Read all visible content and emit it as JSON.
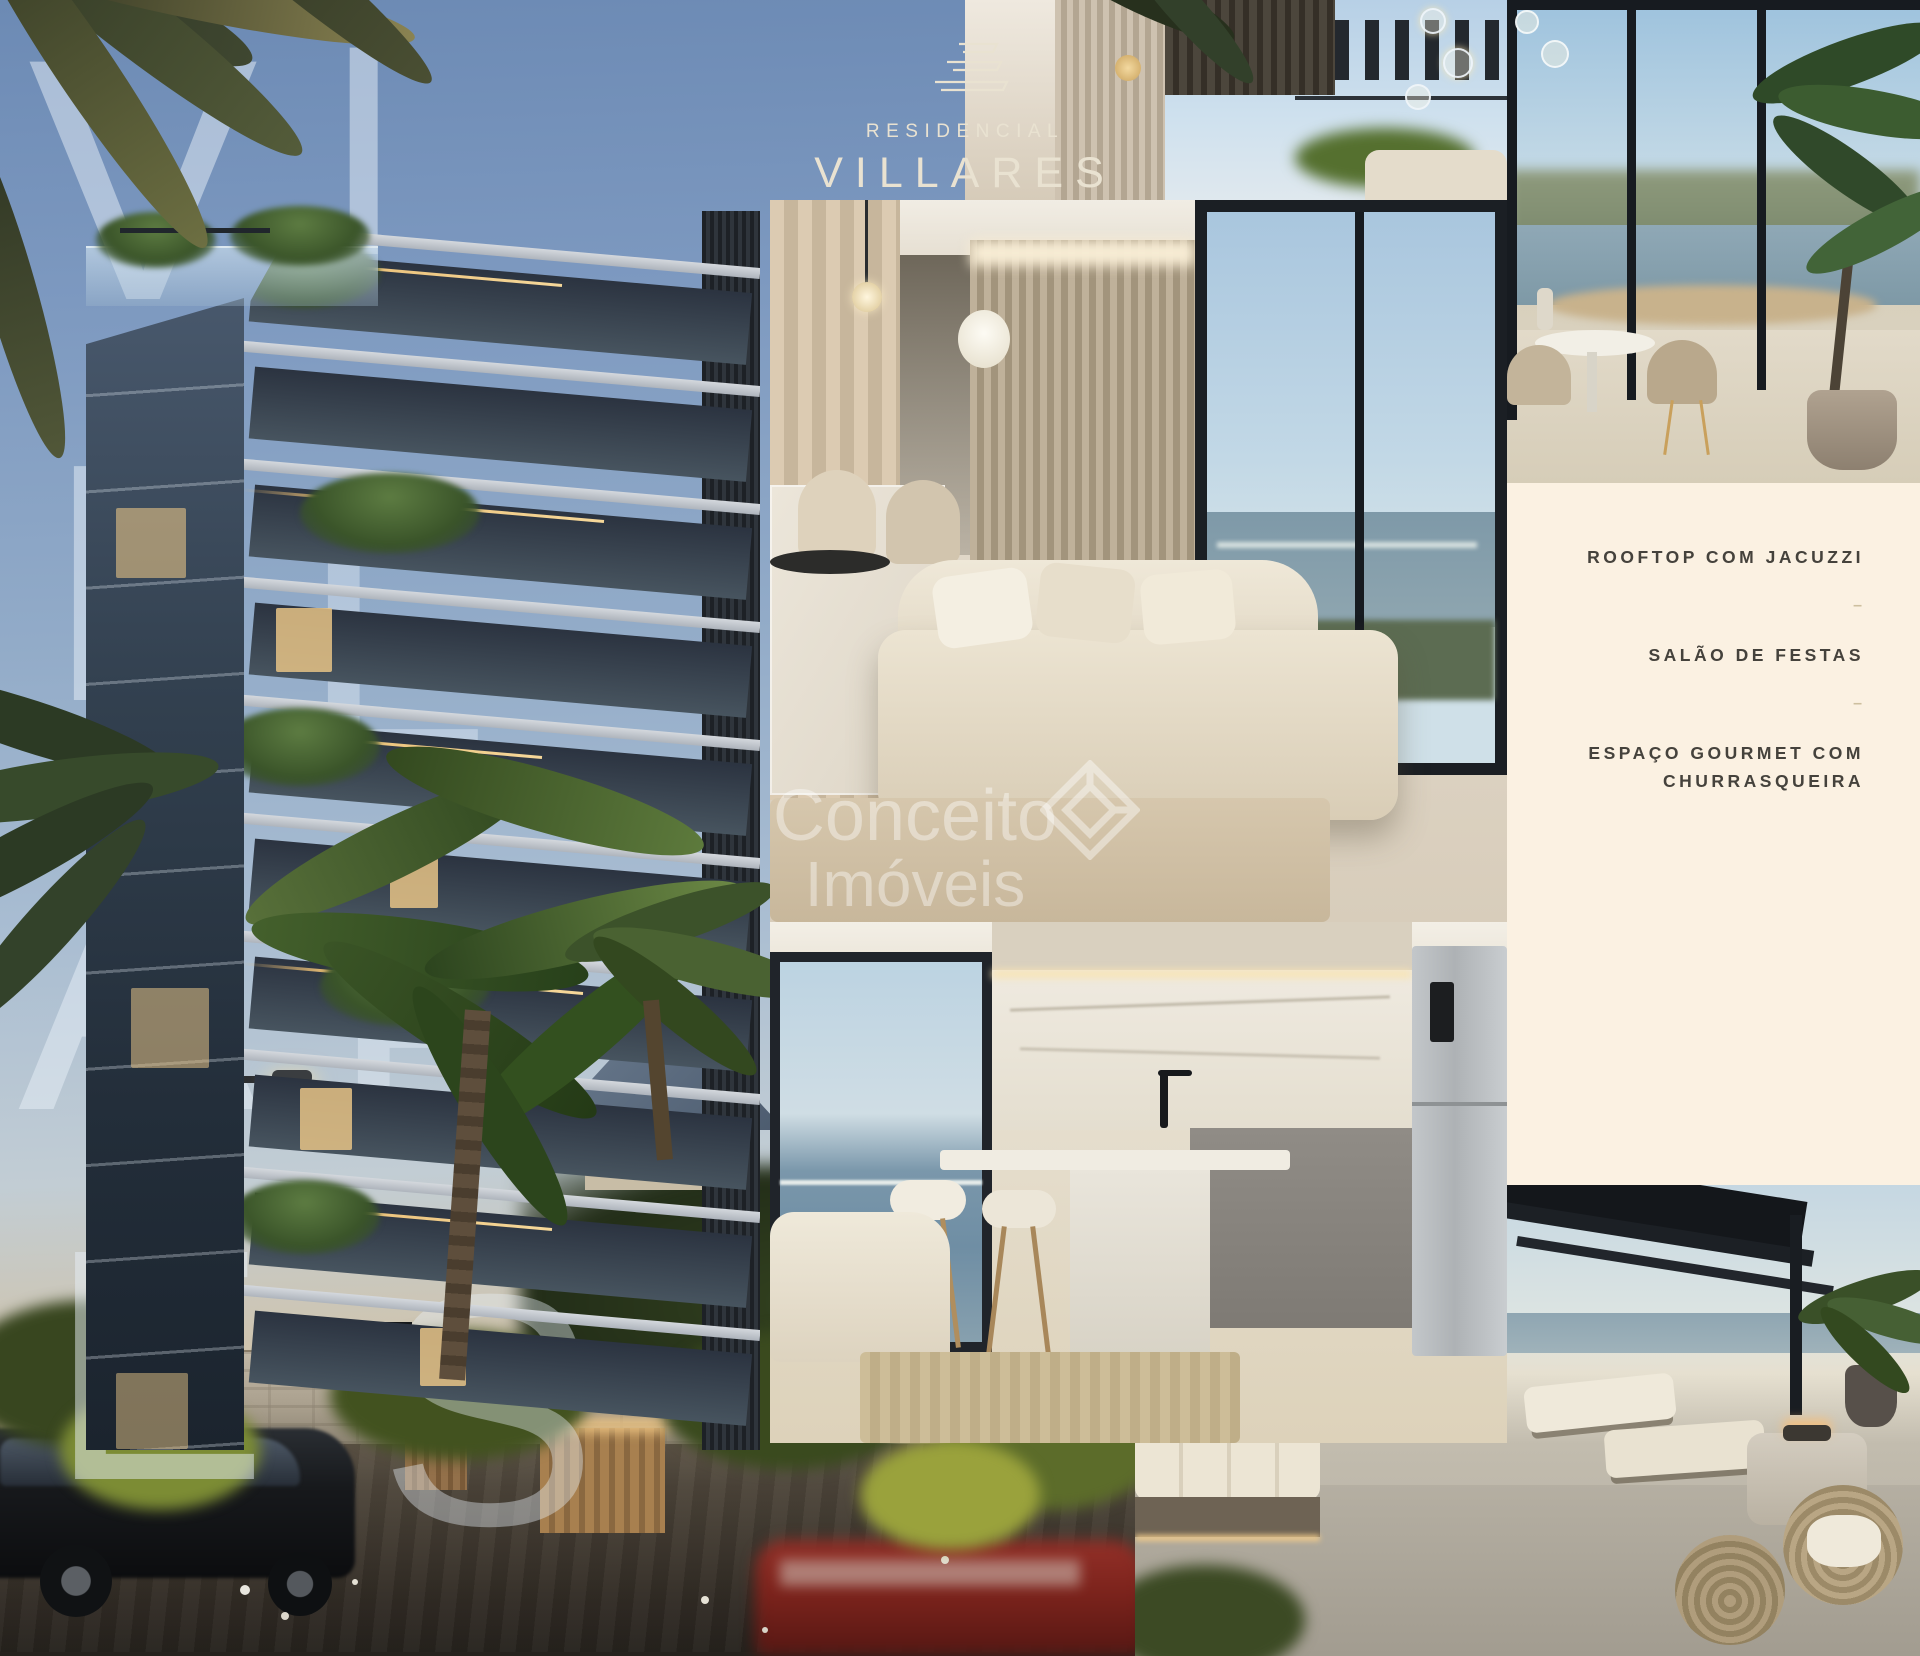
{
  "brand": {
    "upper": "RESIDENCIAL",
    "name": "VILLARES",
    "mark_icon": "stacked-building-floors-icon",
    "color": "#e9e2d1"
  },
  "overlay_letters": [
    "V",
    "I",
    "L",
    "L",
    "A",
    "R",
    "E",
    "S"
  ],
  "amenities": {
    "items": [
      "ROOFTOP COM JACUZZI",
      "SALÃO DE FESTAS",
      "ESPAÇO GOURMET COM CHURRASQUEIRA"
    ],
    "divider": "–",
    "panel_color": "#fbf1e2",
    "text_color": "#45423c"
  },
  "watermark": {
    "line1": "Conceito",
    "line2": "Imóveis",
    "mark_icon": "diamond-gem-icon"
  },
  "tiles": {
    "main": "building-exterior-dusk-render",
    "top_center": "rooftop-pergola-terrace-photo",
    "top_right": "ocean-view-dining-terrace-photo",
    "middle": "living-room-interior-photo",
    "bottom_center": "kitchen-interior-photo",
    "bottom_right": "rooftop-lounge-sunset-photo"
  },
  "colors": {
    "sky_top": "#6c8ab4",
    "cream_panel": "#fbf1e2",
    "warm_led": "#e9bd74",
    "facade": "#8593a4",
    "street": "#35302a"
  }
}
